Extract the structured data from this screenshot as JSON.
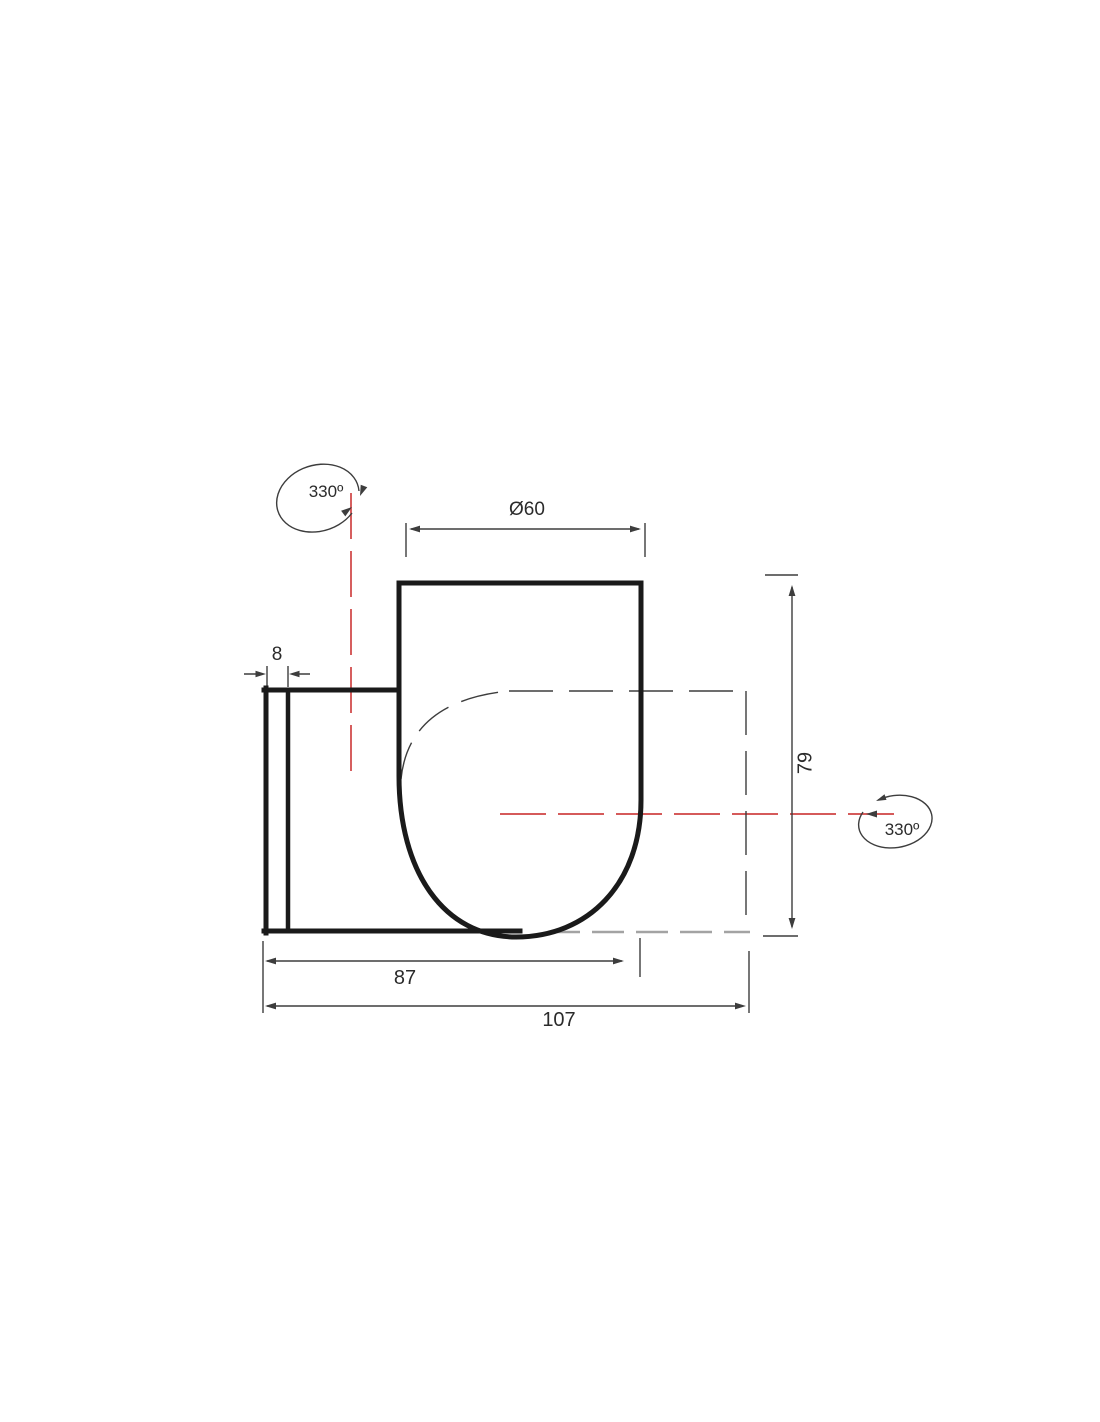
{
  "drawing": {
    "dimensions": {
      "diameter": "Ø60",
      "plate_thickness": "8",
      "body_depth": "87",
      "total_depth": "107",
      "height": "79"
    },
    "rotation": {
      "top": "330º",
      "right": "330º"
    }
  },
  "colors": {
    "background": "#ffffff",
    "outline": "#1a1a1a",
    "thin": "#3d3d3d",
    "text": "#2b2b2b",
    "centerline": "#cf4343",
    "phantom": "#a3a3a3"
  }
}
